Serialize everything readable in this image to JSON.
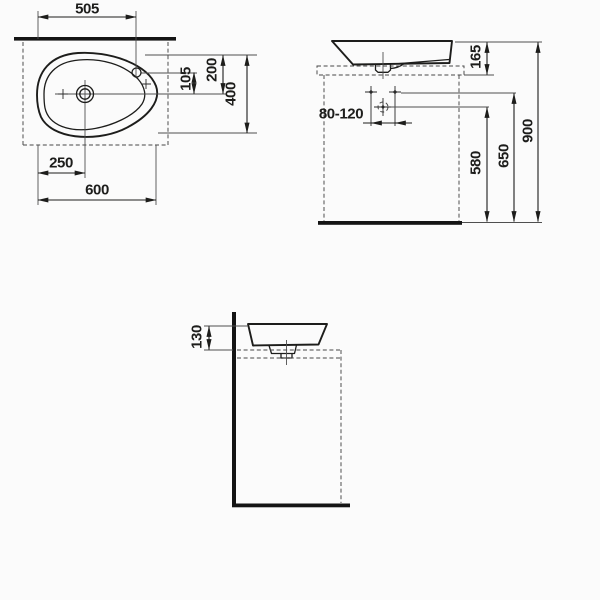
{
  "drawing": {
    "ink_color": "#1d1d1b",
    "background_color": "#fbfbfb",
    "views": {
      "plan": {
        "dims": {
          "faucet_offset_x": "505",
          "faucet_to_drain_y": "105",
          "drain_depth_y": "200",
          "total_depth": "400",
          "drain_offset_x": "250",
          "total_width": "600"
        }
      },
      "front": {
        "dims": {
          "basin_height": "165",
          "supply_spacing": "80-120",
          "drain_connection_height": "580",
          "supply_height": "650",
          "rim_height": "900"
        }
      },
      "side": {
        "dims": {
          "basin_above_counter": "130"
        }
      }
    }
  }
}
